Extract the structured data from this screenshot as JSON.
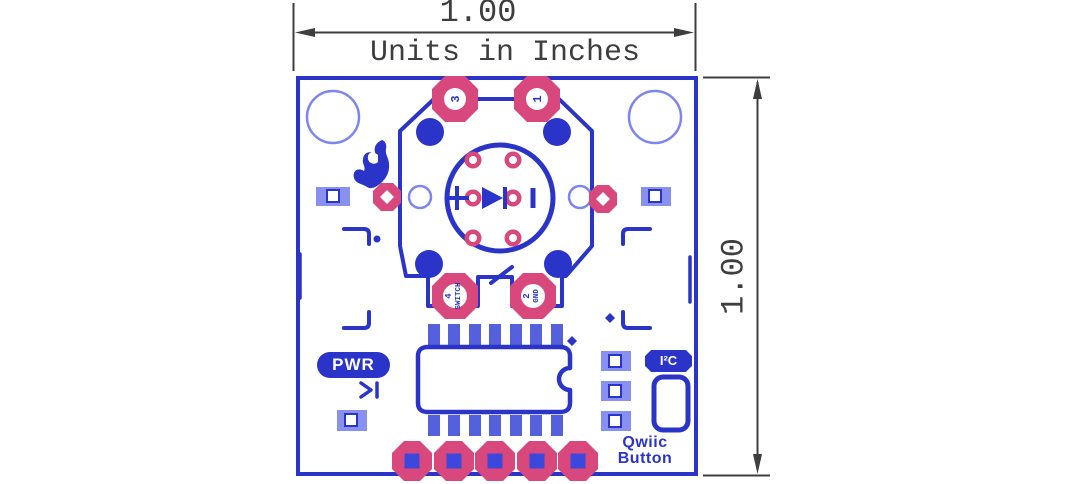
{
  "dimensions": {
    "width_value": "1.00",
    "height_value": "1.00",
    "units_note": "Units in Inches"
  },
  "board": {
    "silkscreen": {
      "pwr_label": "PWR",
      "i2c_label": "I²C",
      "name_line1": "Qwiic",
      "name_line2": "Button"
    },
    "button_pad_labels": {
      "pad3": "3",
      "pad1": "1",
      "pad4_num": "4",
      "pad4_name": "SWITCH",
      "pad2_num": "2",
      "pad2_name": "GND"
    },
    "colors": {
      "trace_blue": "#2a34c8",
      "pad_pink": "#d8487c",
      "light_blue": "#7d86ee",
      "smd_blue": "#8890f0",
      "ic_pad_blue": "#5560dd",
      "dimension_gray": "#3e3e3e"
    }
  }
}
